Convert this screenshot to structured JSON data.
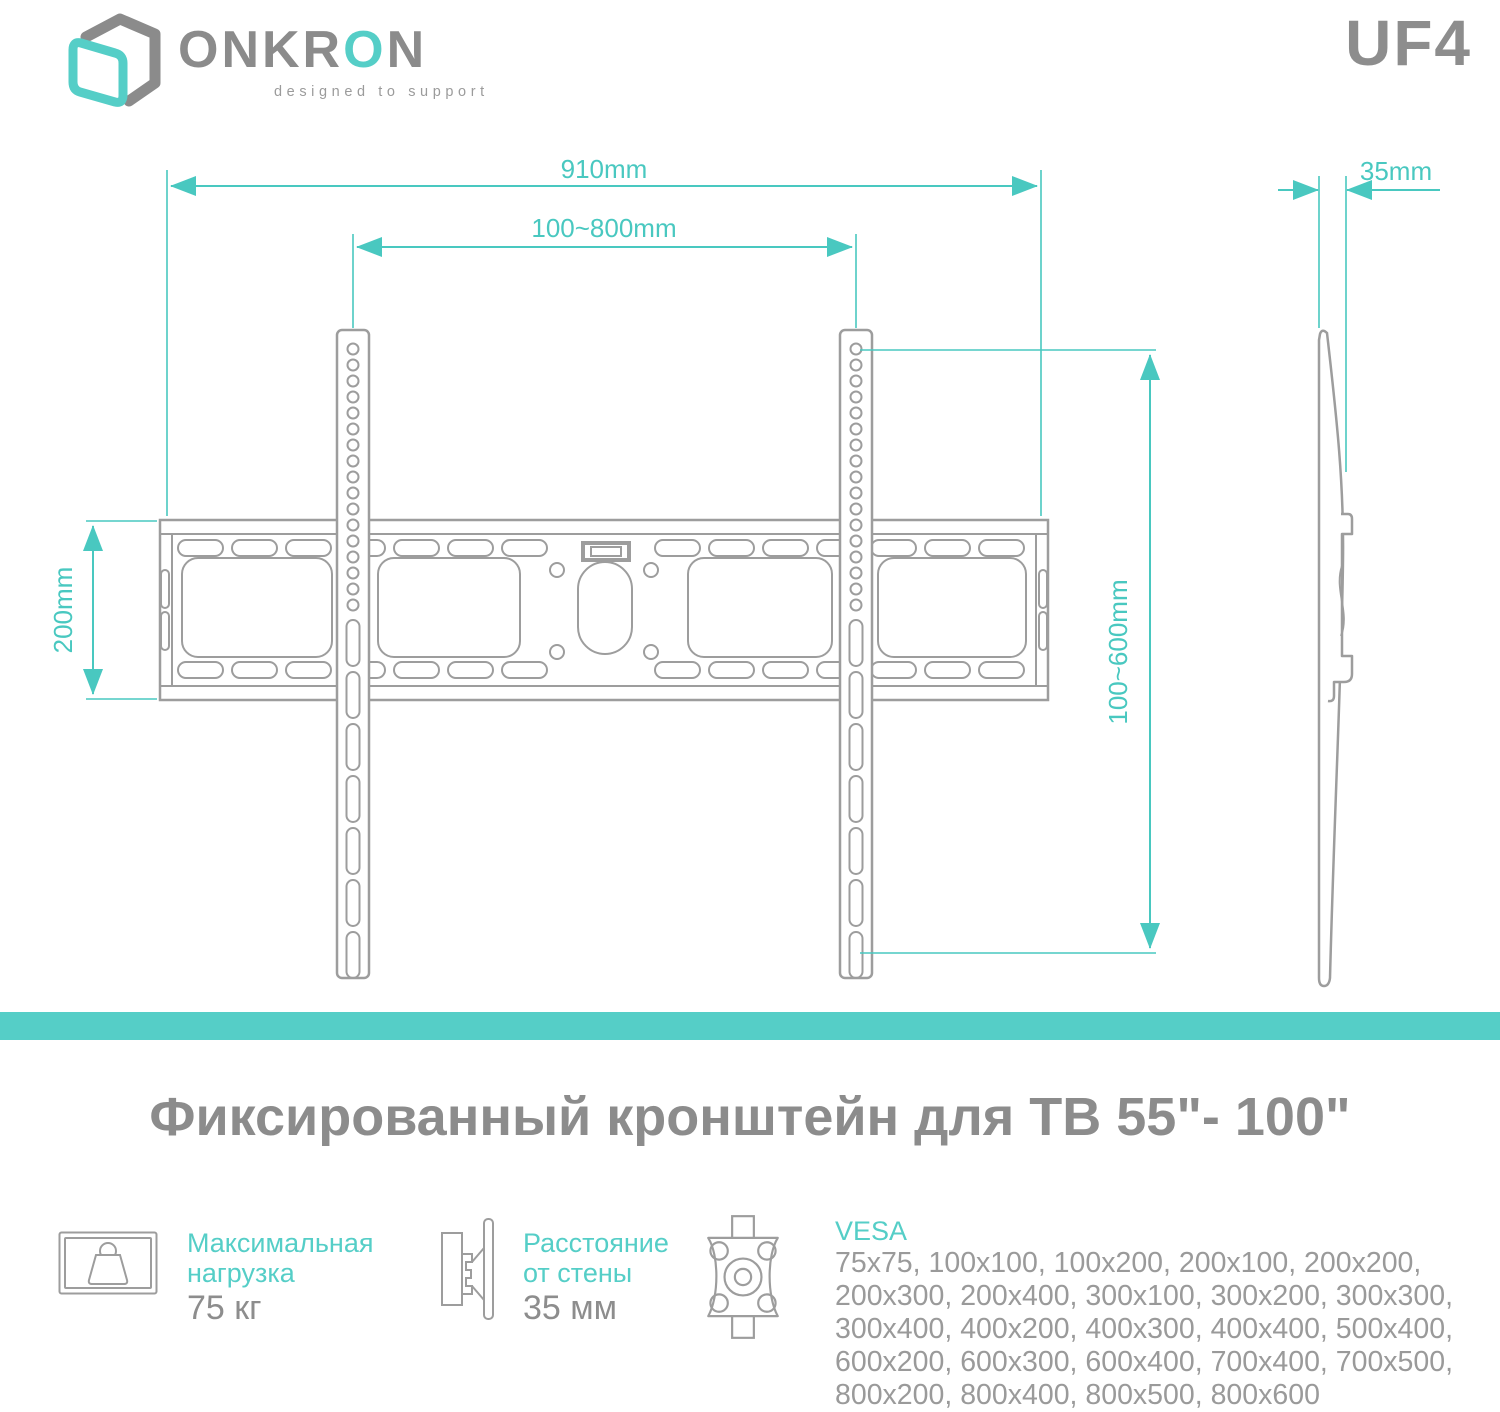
{
  "brand": {
    "name_part1": "ONKR",
    "name_accent": "O",
    "name_part2": "N",
    "tagline": "designed to support",
    "model": "UF4"
  },
  "colors": {
    "accent": "#49c8c0",
    "band": "#55cec7",
    "drawing": "#9d9d9d",
    "text_gray": "#8d8d8d",
    "list_gray": "#9a9a9a",
    "logo_gray": "#8b8b8b"
  },
  "dimensions": {
    "total_width": "910mm",
    "vesa_width_range": "100~800mm",
    "plate_height": "200mm",
    "vesa_height_range": "100~600mm",
    "wall_distance": "35mm"
  },
  "title": "Фиксированный кронштейн для ТВ 55\"- 100\"",
  "specs": {
    "max_load": {
      "label_line1": "Максимальная",
      "label_line2": "нагрузка",
      "value": "75 кг"
    },
    "wall_distance": {
      "label_line1": "Расстояние",
      "label_line2": "от стены",
      "value": "35 мм"
    },
    "vesa": {
      "label": "VESA",
      "lines": [
        "75x75, 100x100, 100x200, 200x100, 200x200,",
        "200x300, 200x400, 300x100, 300x200, 300x300,",
        "300x400, 400x200, 400x300, 400x400, 500x400,",
        "600x200, 600x300, 600x400, 700x400, 700x500,",
        "800x200, 800x400, 800x500, 800x600"
      ]
    }
  }
}
